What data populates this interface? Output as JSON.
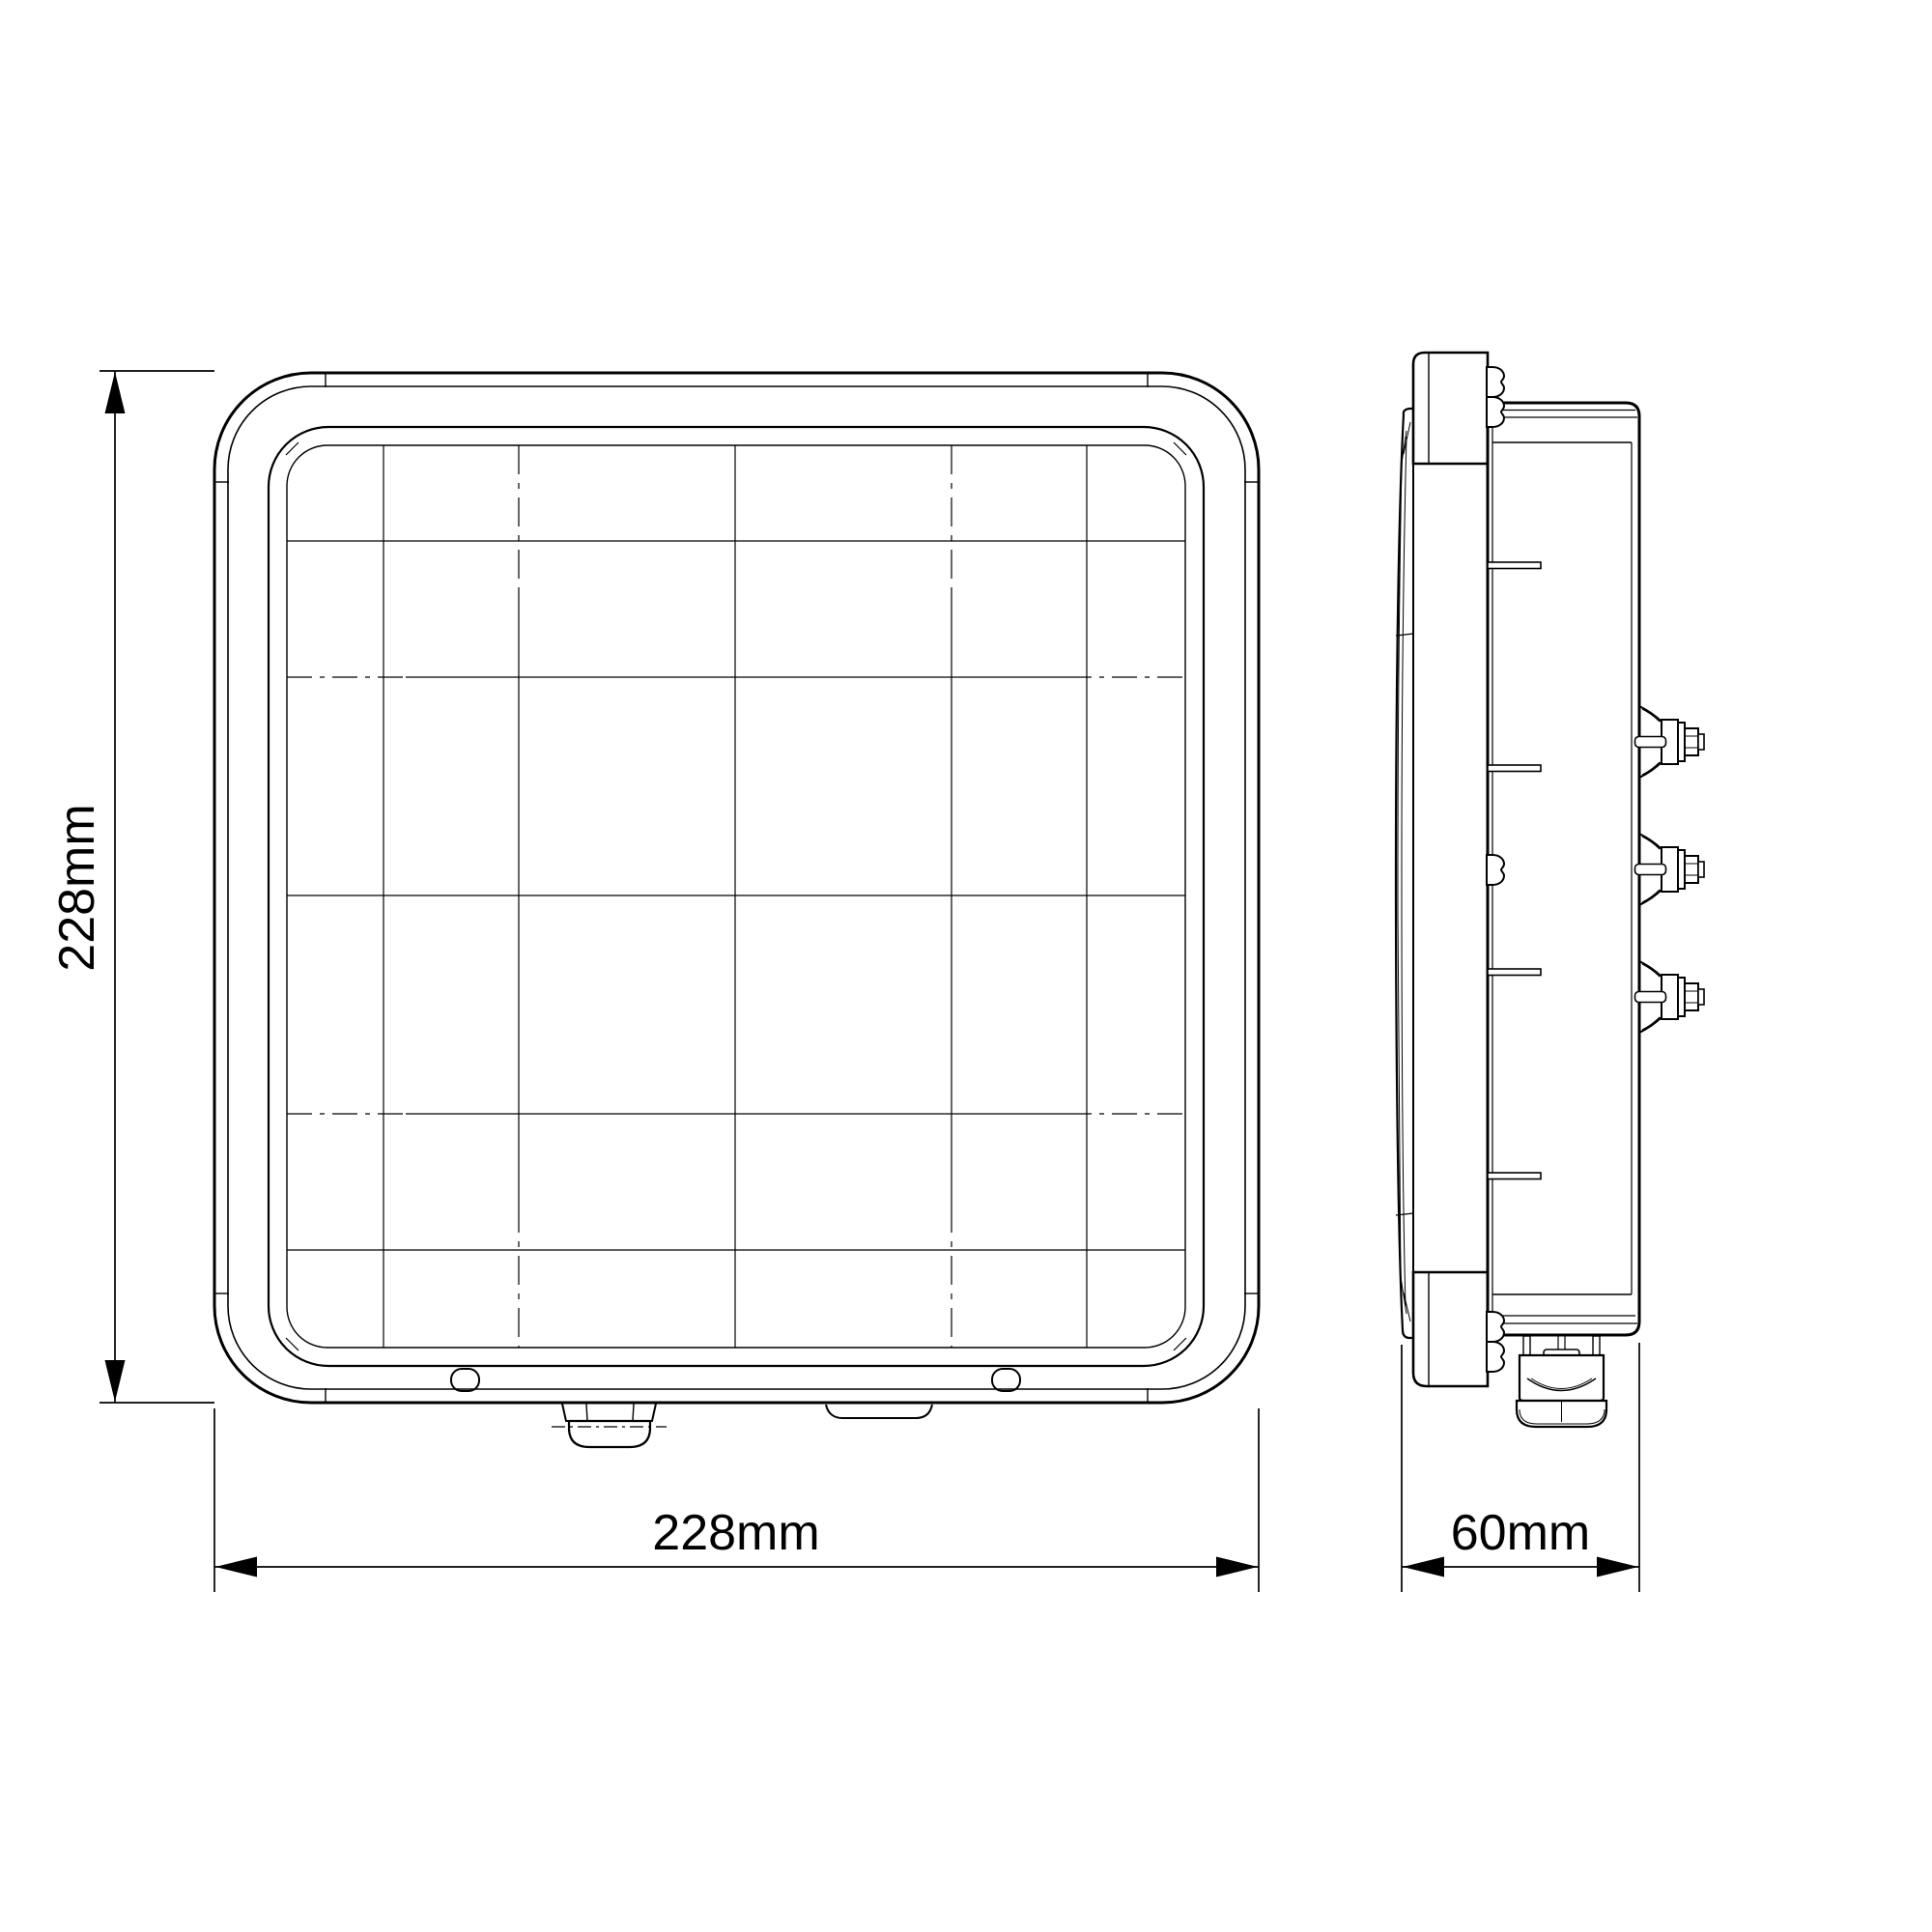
{
  "drawing": {
    "type": "technical-drawing",
    "views": {
      "front": {
        "name": "front view"
      },
      "side": {
        "name": "side view"
      }
    },
    "dimensions": {
      "front_height": "228mm",
      "front_width": "228mm",
      "side_depth": "60mm"
    },
    "colors": {
      "line": "#000000",
      "background": "#ffffff"
    }
  }
}
